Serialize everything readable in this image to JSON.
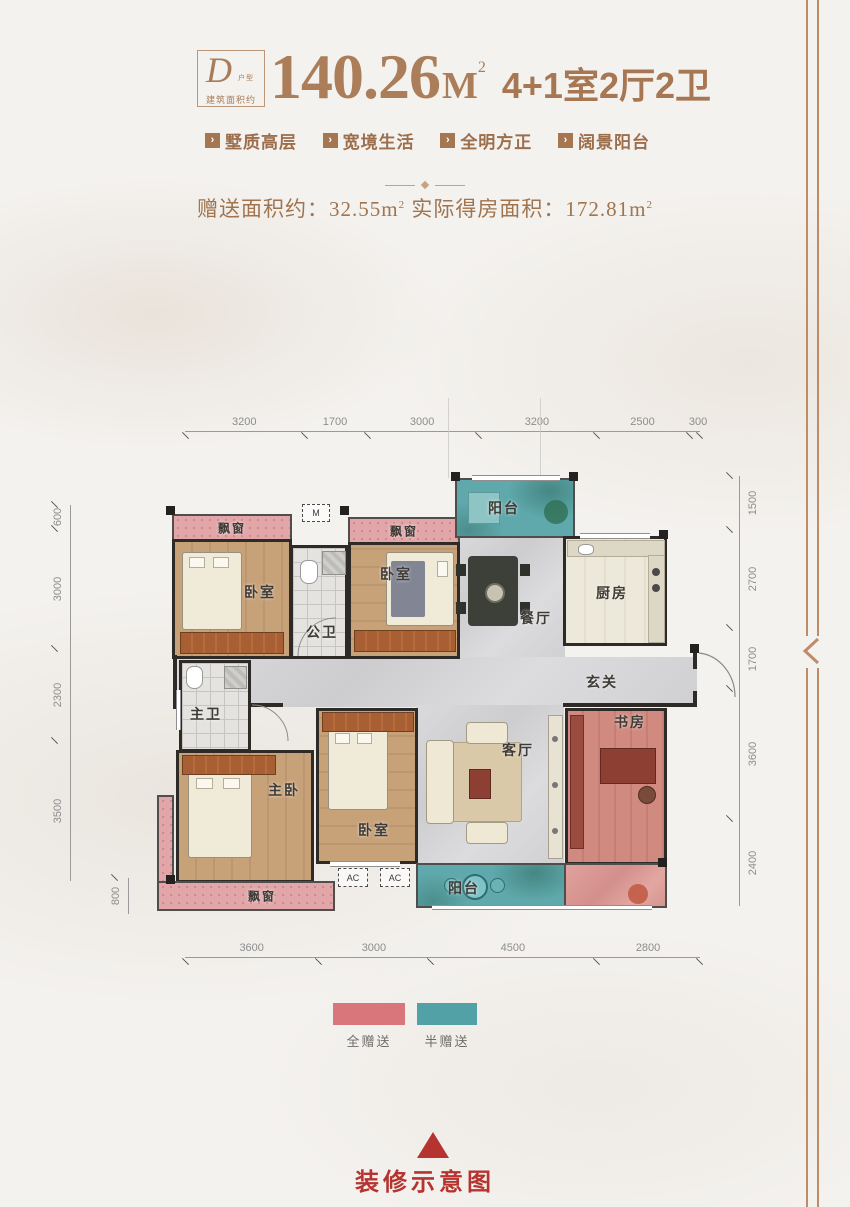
{
  "header": {
    "badge": {
      "letter": "D",
      "type_label": "户型",
      "area_label": "建筑面积约"
    },
    "area_value": "140.26",
    "area_unit": "M",
    "area_sup": "2",
    "layout_text": "4+1室2厅2卫",
    "features": [
      {
        "label": "墅质高层"
      },
      {
        "label": "宽境生活"
      },
      {
        "label": "全明方正"
      },
      {
        "label": "阔景阳台"
      }
    ]
  },
  "gift": {
    "label1": "赠送面积约：",
    "value1": "32.55m",
    "sup1": "2",
    "label2": " 实际得房面积：",
    "value2": "172.81m",
    "sup2": "2"
  },
  "plan": {
    "dims_top": [
      "3200",
      "1700",
      "3000",
      "3200",
      "2500",
      "300"
    ],
    "dims_bottom": [
      "3600",
      "3000",
      "4500",
      "2800"
    ],
    "dims_left": [
      "600",
      "3000",
      "2300",
      "3500"
    ],
    "dim_left_inner": "800",
    "dims_right": [
      "1500",
      "2700",
      "1700",
      "3600",
      "2400"
    ],
    "rooms": {
      "bay_window_1": "飘窗",
      "bay_window_2": "飘窗",
      "bay_window_3": "飘窗",
      "bedroom_1": "卧室",
      "bedroom_2": "卧室",
      "bedroom_3": "卧室",
      "public_bath": "公卫",
      "master_bath": "主卫",
      "master_bedroom": "主卧",
      "dining": "餐厅",
      "kitchen": "厨房",
      "foyer": "玄关",
      "living": "客厅",
      "study": "书房",
      "balcony_top": "阳台",
      "balcony_bottom": "阳台"
    },
    "markers": {
      "vent": "M",
      "ac_1": "AC",
      "ac_2": "AC"
    }
  },
  "legend": {
    "full_gift": {
      "label": "全赠送",
      "color": "#d9767b"
    },
    "half_gift": {
      "label": "半赠送",
      "color": "#51a1a7"
    }
  },
  "footer": {
    "caption": "装修示意图"
  },
  "theme": {
    "accent_brown": "#a97c58",
    "accent_red": "#b5342f"
  }
}
